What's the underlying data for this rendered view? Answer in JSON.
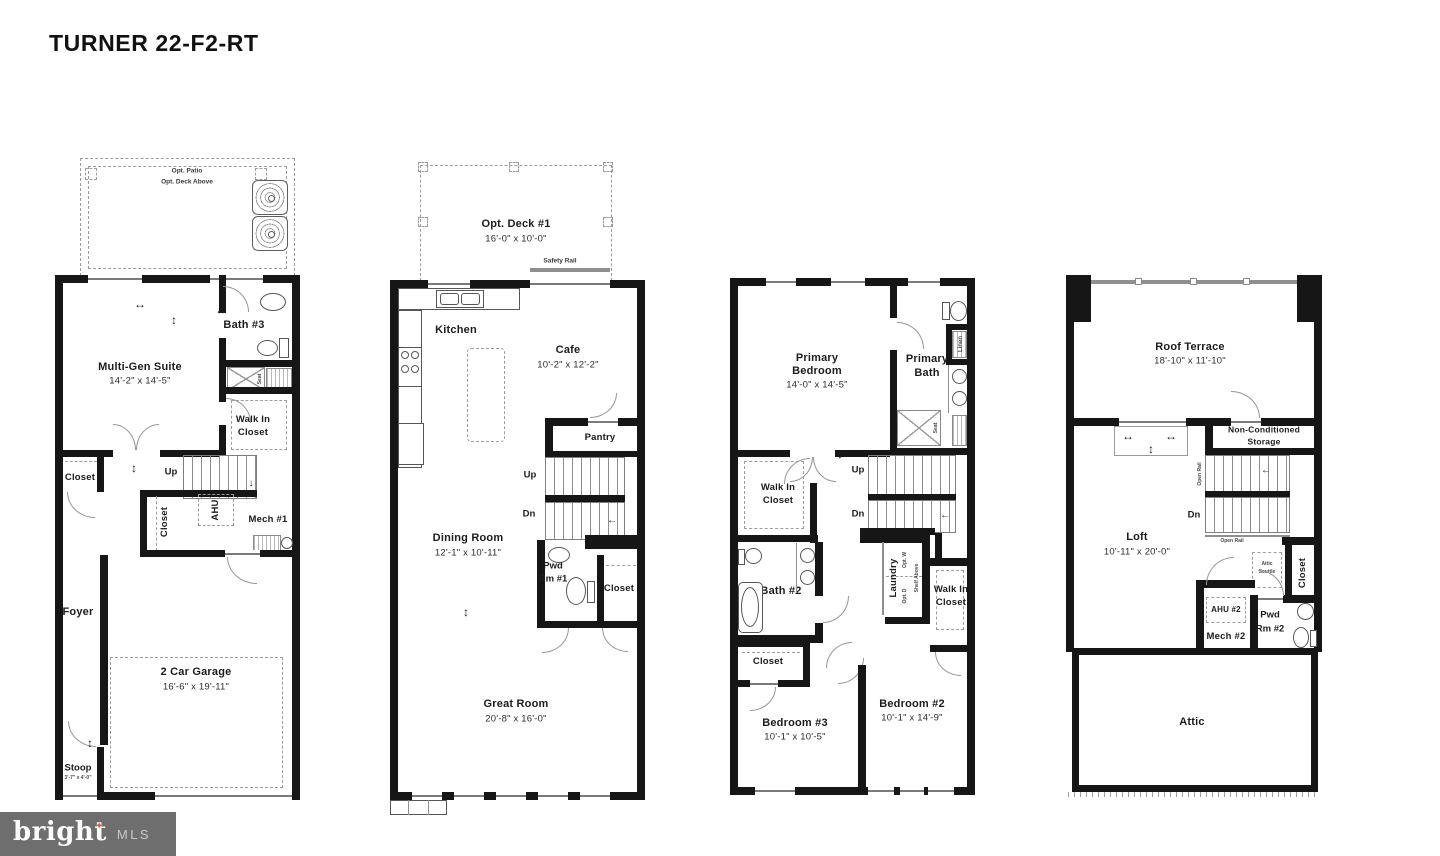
{
  "title": "TURNER 22-F2-RT",
  "logo": {
    "brand": "bright",
    "mls": "MLS",
    "tm": "TM"
  },
  "icons": {
    "logo_star": "✦",
    "arrow_h": "↔",
    "arrow_v": "↕",
    "arrow_left": "←",
    "arrow_down": "↓"
  },
  "colors": {
    "wall": "#161616",
    "line": "#8a8a8a",
    "logo_bg": "#6e6e6e",
    "logo_star": "#e4593b"
  },
  "floor1": {
    "opt_patio": "Opt. Patio",
    "opt_deck_above": "Opt. Deck Above",
    "multigen": "Multi-Gen Suite",
    "multigen_dims": "14'-2\" x 14'-5\"",
    "bath3": "Bath #3",
    "seat": "Seat",
    "walkin_1": "Walk In",
    "walkin_2": "Closet",
    "closet_left": "Closet",
    "up": "Up",
    "closet_mid": "Closet",
    "ahu": "AHU",
    "mech1": "Mech #1",
    "foyer": "Foyer",
    "garage": "2 Car Garage",
    "garage_dims": "16'-6\" x 19'-11\"",
    "stoop": "Stoop",
    "stoop_dims": "3'-7\" x 4'-0\""
  },
  "floor2": {
    "opt_deck": "Opt. Deck #1",
    "opt_deck_dims": "16'-0\" x 10'-0\"",
    "safety_rail": "Safety Rail",
    "kitchen": "Kitchen",
    "cafe": "Cafe",
    "cafe_dims": "10'-2\" x 12'-2\"",
    "pantry": "Pantry",
    "up": "Up",
    "dn": "Dn",
    "dining": "Dining Room",
    "dining_dims": "12'-1\" x 10'-11\"",
    "pwd_1": "Pwd",
    "pwd_2": "Rm #1",
    "closet": "Closet",
    "great": "Great Room",
    "great_dims": "20'-8\" x 16'-0\""
  },
  "floor3": {
    "primary_1": "Primary",
    "primary_2": "Bedroom",
    "primary_dims": "14'-0\" x 14'-5\"",
    "pbath_1": "Primary",
    "pbath_2": "Bath",
    "linen": "Linen",
    "seat": "Seat",
    "wic_1": "Walk In",
    "wic_2": "Closet",
    "up": "Up",
    "dn": "Dn",
    "bath2": "Bath #2",
    "laundry": "Laundry",
    "opt_w": "Opt. W",
    "opt_d": "Opt. D",
    "shelf_above": "Shelf Above",
    "wicr_1": "Walk In",
    "wicr_2": "Closet",
    "closet": "Closet",
    "bed3": "Bedroom #3",
    "bed3_dims": "10'-1\" x 10'-5\"",
    "bed2": "Bedroom #2",
    "bed2_dims": "10'-1\" x 14'-9\""
  },
  "floor4": {
    "terrace": "Roof Terrace",
    "terrace_dims": "18'-10\" x 11'-10\"",
    "storage_1": "Non-Conditioned",
    "storage_2": "Storage",
    "open_rail_v": "Open Rail",
    "open_rail_h": "Open Rail",
    "dn": "Dn",
    "loft": "Loft",
    "loft_dims": "10'-11\" x 20'-0\"",
    "closet": "Closet",
    "scuttle_1": "Attic",
    "scuttle_2": "Scuttle",
    "ahu2": "AHU #2",
    "mech2": "Mech #2",
    "pwd_1": "Pwd",
    "pwd_2": "Rm #2",
    "attic": "Attic"
  }
}
